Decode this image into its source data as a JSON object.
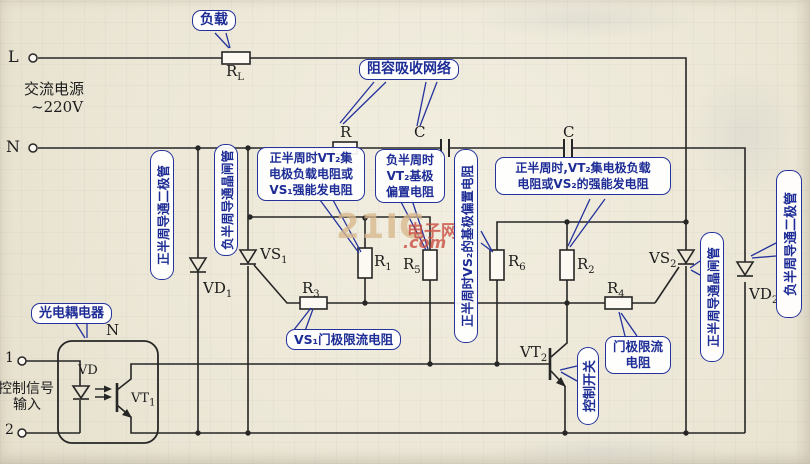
{
  "power": {
    "l_terminal": "L",
    "n_terminal": "N",
    "ac_line1": "交流电源",
    "ac_line2": "~220V",
    "input_1": "1",
    "input_2": "2",
    "control_line1": "控制信号",
    "control_line2": "输入"
  },
  "components": {
    "rl": {
      "base": "R",
      "sub": "L"
    },
    "r_snubber": "R",
    "c_snubber_1": "C",
    "c_snubber_2": "C",
    "r1": {
      "base": "R",
      "sub": "1"
    },
    "r2": {
      "base": "R",
      "sub": "2"
    },
    "r3": {
      "base": "R",
      "sub": "3"
    },
    "r4": {
      "base": "R",
      "sub": "4"
    },
    "r5": {
      "base": "R",
      "sub": "5"
    },
    "r6": {
      "base": "R",
      "sub": "6"
    },
    "vd1": {
      "base": "VD",
      "sub": "1"
    },
    "vd2": {
      "base": "VD",
      "sub": "2"
    },
    "vs1": {
      "base": "VS",
      "sub": "1"
    },
    "vs2": {
      "base": "VS",
      "sub": "2"
    },
    "vt1": {
      "base": "VT",
      "sub": "1"
    },
    "vt2": {
      "base": "VT",
      "sub": "2"
    },
    "vd_led": "VD",
    "opto_n": "N"
  },
  "callouts": {
    "load": "负载",
    "snubber": "阻容吸收网络",
    "pos_diode": "正半周导通二极管",
    "neg_scr": "负半周导通晶闸管",
    "r1_note": {
      "lines": [
        "正半周时VT₂集",
        "电极负载电阻或",
        "VS₁强能发电阻"
      ]
    },
    "r5_note": {
      "lines": [
        "负半周时",
        "VT₂基极",
        "偏置电阻"
      ]
    },
    "r6_note": "正半周时VS₂的基极偏置电阻",
    "r2_note": {
      "lines": [
        "正半周时,VT₂集电极负载",
        "电阻或VS₂的强能发电阻"
      ]
    },
    "r3_note": "VS₁门极限流电阻",
    "r4_note": {
      "lines": [
        "门极限流",
        "电阻"
      ]
    },
    "switch_note": "控制开关",
    "pos_scr": "正半周导通晶闸管",
    "neg_diode": "负半周导通二极管",
    "opto": "光电耦电器"
  },
  "watermark": {
    "big": "21IC",
    "cn": "电子网",
    "com": ".com"
  },
  "colors": {
    "callout_blue": "#1e2d96",
    "wire": "#262626",
    "watermark_tan": "#d8b88d",
    "watermark_red": "#c94a3d",
    "paper": "#ede8d8"
  }
}
